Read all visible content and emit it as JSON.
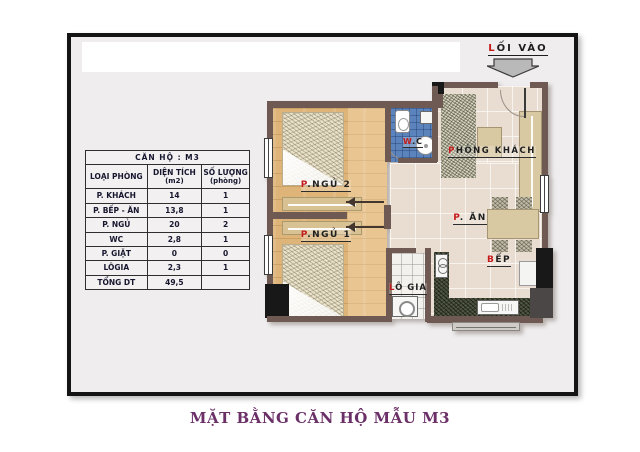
{
  "entrance": {
    "initial": "L",
    "rest": "ỐI VÀO"
  },
  "rooms": {
    "bedroom2": {
      "initial": "P",
      "rest": ".NGỦ 2"
    },
    "bedroom1": {
      "initial": "P",
      "rest": ".NGỦ 1"
    },
    "wc": {
      "initial": "W",
      "rest": ".C"
    },
    "living": {
      "initial": "P",
      "rest": "HÒNG KHÁCH"
    },
    "dining": {
      "initial": "P",
      "rest": ". ĂN"
    },
    "kitchen": {
      "initial": "B",
      "rest": "ẾP"
    },
    "loggia": {
      "initial": "L",
      "rest": "Ô GIA"
    }
  },
  "table": {
    "title": "CĂN HỘ : M3",
    "columns": [
      {
        "label": "LOẠI PHÒNG",
        "sub": ""
      },
      {
        "label": "DIỆN TÍCH",
        "sub": "(m2)"
      },
      {
        "label": "SỐ LƯỢNG",
        "sub": "(phòng)"
      }
    ],
    "rows": [
      {
        "room": "P. KHÁCH",
        "area": "14",
        "count": "1"
      },
      {
        "room": "P. BẾP - ĂN",
        "area": "13,8",
        "count": "1"
      },
      {
        "room": "P. NGỦ",
        "area": "20",
        "count": "2"
      },
      {
        "room": "WC",
        "area": "2,8",
        "count": "1"
      },
      {
        "room": "P. GIẶT",
        "area": "0",
        "count": "0"
      },
      {
        "room": "LÔGIA",
        "area": "2,3",
        "count": "1"
      },
      {
        "room": "TỔNG DT",
        "area": "49,5",
        "count": ""
      }
    ]
  },
  "caption": "MẶT BẰNG CĂN HỘ MẪU M3",
  "colors": {
    "accent_red": "#c41a1a",
    "caption_purple": "#6b3067",
    "wall_brown": "#6e5a52",
    "wood_floor": "#dfb478",
    "tile_floor": "#e9dcd0",
    "wc_blue": "#5b84bd",
    "counter_green": "#3f4631",
    "arrow_gray": "#b9b9b9"
  }
}
